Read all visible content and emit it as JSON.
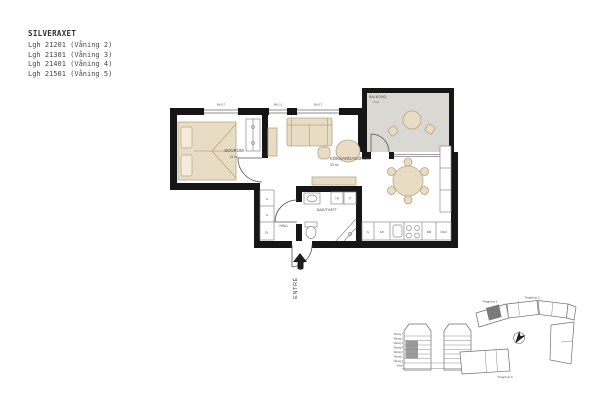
{
  "header": {
    "title": "SILVERAXET",
    "apartments": [
      "Lgh 21201 (Våning 2)",
      "Lgh 21301 (Våning 3)",
      "Lgh 21401 (Våning 4)",
      "Lgh 21501 (Våning 5)"
    ]
  },
  "plan": {
    "rooms": {
      "bedroom": {
        "name": "SOVRUM",
        "area": "11 m²"
      },
      "living": {
        "name": "KÖK/VARDAGSRUM",
        "area": "33 m²"
      },
      "balcony": {
        "name": "BALKONG",
        "area": "7 m²"
      },
      "hall": {
        "name": "HALL"
      },
      "bath": {
        "name": "BAD/TVÄTT"
      }
    },
    "entrance_label": "ENTRÉ",
    "windows": {
      "sill_left": "Bh 0,7",
      "sill_mid": "Bh 1,1",
      "sill_right": "Bh 0,7"
    },
    "fixtures": {
      "wardrobe": "G",
      "electric": "EL",
      "fridge_freezer": "K/F",
      "dishwasher": "DM",
      "oven": "UGN",
      "washer": "TM",
      "dryer": "TT"
    }
  },
  "elevation": {
    "floors": [
      "Våning 7",
      "Våning 6",
      "Våning 5",
      "Våning 4",
      "Våning 3",
      "Våning 2",
      "Våning 1",
      "Entré"
    ]
  },
  "siteplan": {
    "stairs": [
      "Trapphus 1",
      "Trapphus 2",
      "Trapphus 3"
    ]
  },
  "colors": {
    "wall": "#161616",
    "furniture": "#e9dcc4",
    "furniture_stroke": "#b6a687",
    "balcony_floor": "#d9d8d3",
    "highlight_unit": "#7a7a7a",
    "text": "#4a4a4a"
  }
}
